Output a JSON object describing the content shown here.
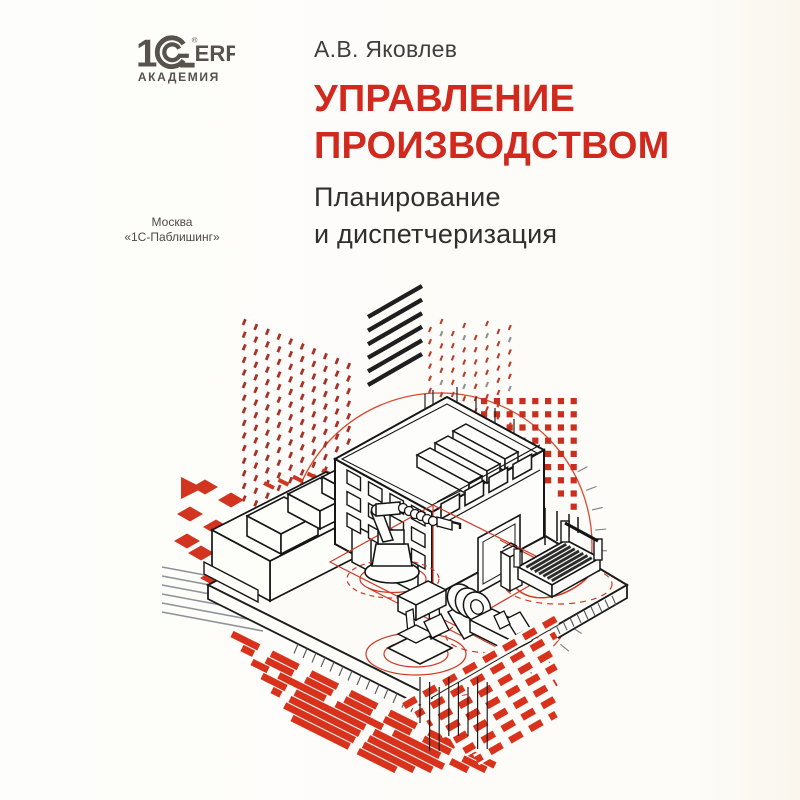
{
  "logo": {
    "one": "1",
    "erp": "ERP",
    "reg": "®",
    "series": "АКАДЕМИЯ"
  },
  "author": "А.В. Яковлев",
  "title": {
    "line1": "УПРАВЛЕНИЕ",
    "line2": "ПРОИЗВОДСТВОМ"
  },
  "subtitle": {
    "line1": "Планирование",
    "line2": "и диспетчеризация"
  },
  "imprint": {
    "city": "Москва",
    "publisher": "«1С-Паблишинг»"
  },
  "colors": {
    "title_red": "#d2291f",
    "illustration_red": "#d8311c",
    "dot_red": "#a83227",
    "ink": "#1c1c1c",
    "logo_gray": "#57524b",
    "background": "#fdfcfa"
  },
  "illustration": {
    "elements": [
      "factory-building",
      "roof-vents",
      "industrial-robot-arm",
      "drill-press",
      "lathe",
      "cnc-router",
      "control-cabinet",
      "crates",
      "annex-wall",
      "halftone-dot-grid",
      "red-square-grid",
      "diagonal-hatch",
      "chevron-stripes",
      "basket-weave",
      "checker-diamonds",
      "orbit-circle",
      "floor-zone-lines"
    ]
  }
}
